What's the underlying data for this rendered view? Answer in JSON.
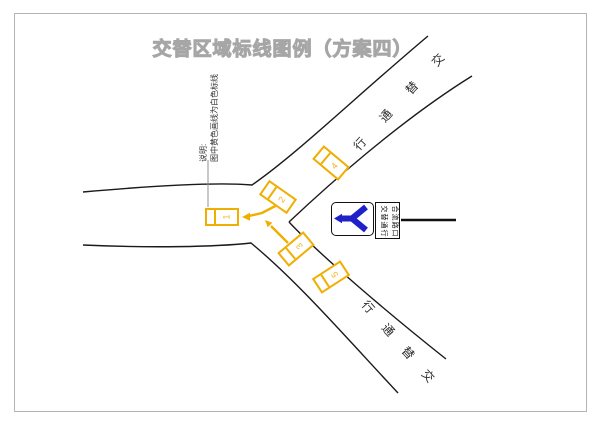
{
  "page": {
    "title": "交替区域标线图例（方案四）"
  },
  "annotation": {
    "label": "说明:",
    "text": "图中黄色画线为白色标线"
  },
  "roads": {
    "upper_branch_chars": [
      "交",
      "替",
      "通",
      "行"
    ],
    "lower_branch_chars": [
      "行",
      "通",
      "替",
      "交"
    ]
  },
  "cars": [
    {
      "number": "1"
    },
    {
      "number": "2"
    },
    {
      "number": "3"
    },
    {
      "number": "4"
    },
    {
      "number": "5"
    }
  ],
  "sign": {
    "symbol": "y-merge-left-arrow",
    "line1": "合流路口",
    "line2": "交替通行"
  },
  "colors": {
    "marking_yellow": "#f0ae00",
    "sign_blue": "#1e22c8",
    "road_black": "#1a1a1a",
    "title_gray": "#a6a6a6"
  }
}
